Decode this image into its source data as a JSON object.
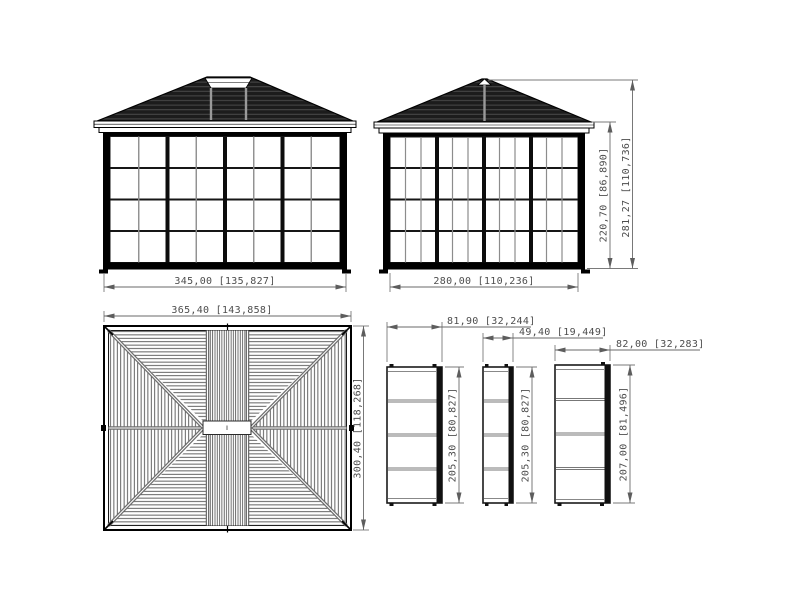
{
  "document": {
    "type": "technical-dimension-drawing",
    "subject": "gazebo-sunroom-with-hip-roof",
    "background": "#ffffff"
  },
  "colors": {
    "linework": "#000000",
    "roof_fill": "#1c1c1c",
    "roof_slat_line": "#4f4f4f",
    "mullion_gray": "#8c8c8c",
    "divider_gray": "#767676",
    "dimension_text": "#4d4d4d",
    "dimension_line": "#6a6a6a"
  },
  "views": {
    "front_elevation": {
      "width_dim": "345,00 [135,827]"
    },
    "side_elevation": {
      "width_dim": "280,00 [110,236]",
      "wall_height_dim": "220,70 [86,890]",
      "overall_height_dim": "281,27 [110,736]"
    },
    "roof_plan": {
      "width_dim": "365,40 [143,858]",
      "depth_dim": "300,40 [118,268]"
    },
    "panels": [
      {
        "width_dim": "81,90 [32,244]",
        "height_dim": "205,30 [80,827]"
      },
      {
        "width_dim": "49,40 [19,449]",
        "height_dim": "205,30 [80,827]"
      },
      {
        "width_dim": "82,00 [32,283]",
        "height_dim": "207,00 [81,496]"
      }
    ]
  }
}
